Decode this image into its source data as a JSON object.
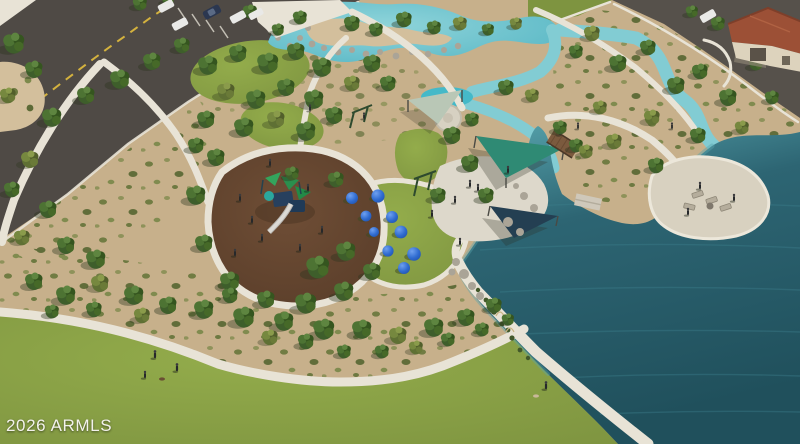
{
  "watermark": {
    "text": "2026 ARMLS"
  },
  "scene": {
    "type": "aerial-park-rendering",
    "features": [
      "parking-lot",
      "entry-road",
      "lagoon-with-rocks",
      "winding-streams",
      "large-lake",
      "playground-mulch-area",
      "play-structure",
      "blue-play-domes",
      "shade-sail-plaza",
      "splash-pad",
      "lakeside-patio",
      "wood-bridge",
      "great-lawn",
      "walking-paths",
      "desert-planting",
      "house-with-tile-roof",
      "people-and-dogs"
    ]
  },
  "palette": {
    "sand": "#c7b08b",
    "sand2": "#d3bf9c",
    "asphalt": "#4f4a45",
    "asphalt2": "#56514b",
    "path": "#e8e3d6",
    "lawn": "#7e9440",
    "lawn_light": "#93ac4b",
    "lawn_dark": "#6a8236",
    "mulch": "#6f4e36",
    "mulch_dark": "#593d29",
    "lagoon": "#56b6c4",
    "lagoon_light": "#8fd4da",
    "stream": "#82ccd3",
    "pool": "#45b9c8",
    "lake": "#2d6573",
    "lake_deep": "#20505c",
    "lake_shallow": "#58a5ae",
    "rock": "#aaa497",
    "roof": "#9c5036",
    "wall": "#ddd3bd",
    "sail_teal": "#2f8a74",
    "sail_navy": "#243f52",
    "sail_pale": "#b9c7b6",
    "dome_blue": "#2f6bd0",
    "dome_blue_dark": "#1f4ea6",
    "car_white": "#e9e9e7",
    "car_navy": "#2b3750",
    "line_yellow": "#d4b23e",
    "tree_dark": "#3e5e2b",
    "tree_olive": "#5f7034",
    "reed": "#42582a",
    "people": "#26282a"
  }
}
